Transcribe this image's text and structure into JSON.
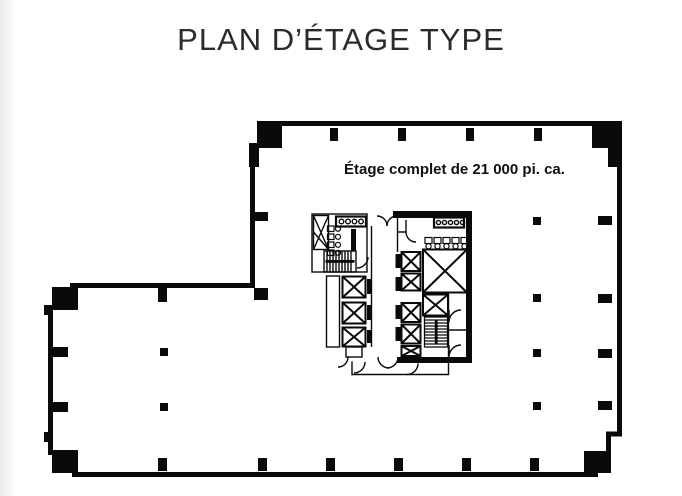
{
  "page": {
    "title": "PLAN D’ÉTAGE TYPE"
  },
  "plan": {
    "area_label": "Étage complet de 21 000 pi. ca.",
    "colors": {
      "walls": "#0a0a0a",
      "background": "#ffffff",
      "page_edge": "#ebebeb",
      "text": "#101010"
    },
    "icons": {
      "elevator-icon": "square-with-x-diagonals",
      "stairs-icon": "hatched-tread-lines-with-rail",
      "scissor-stair-icon": "tall-box-with-x",
      "toilet-icon": "small-rect-with-circle",
      "sink-icon": "counter-with-circle-row",
      "urinal-icon": "small-rect-with-circle",
      "door-swing-icon": "quarter-circle-arc",
      "column-marker-icon": "filled-black-square"
    }
  }
}
